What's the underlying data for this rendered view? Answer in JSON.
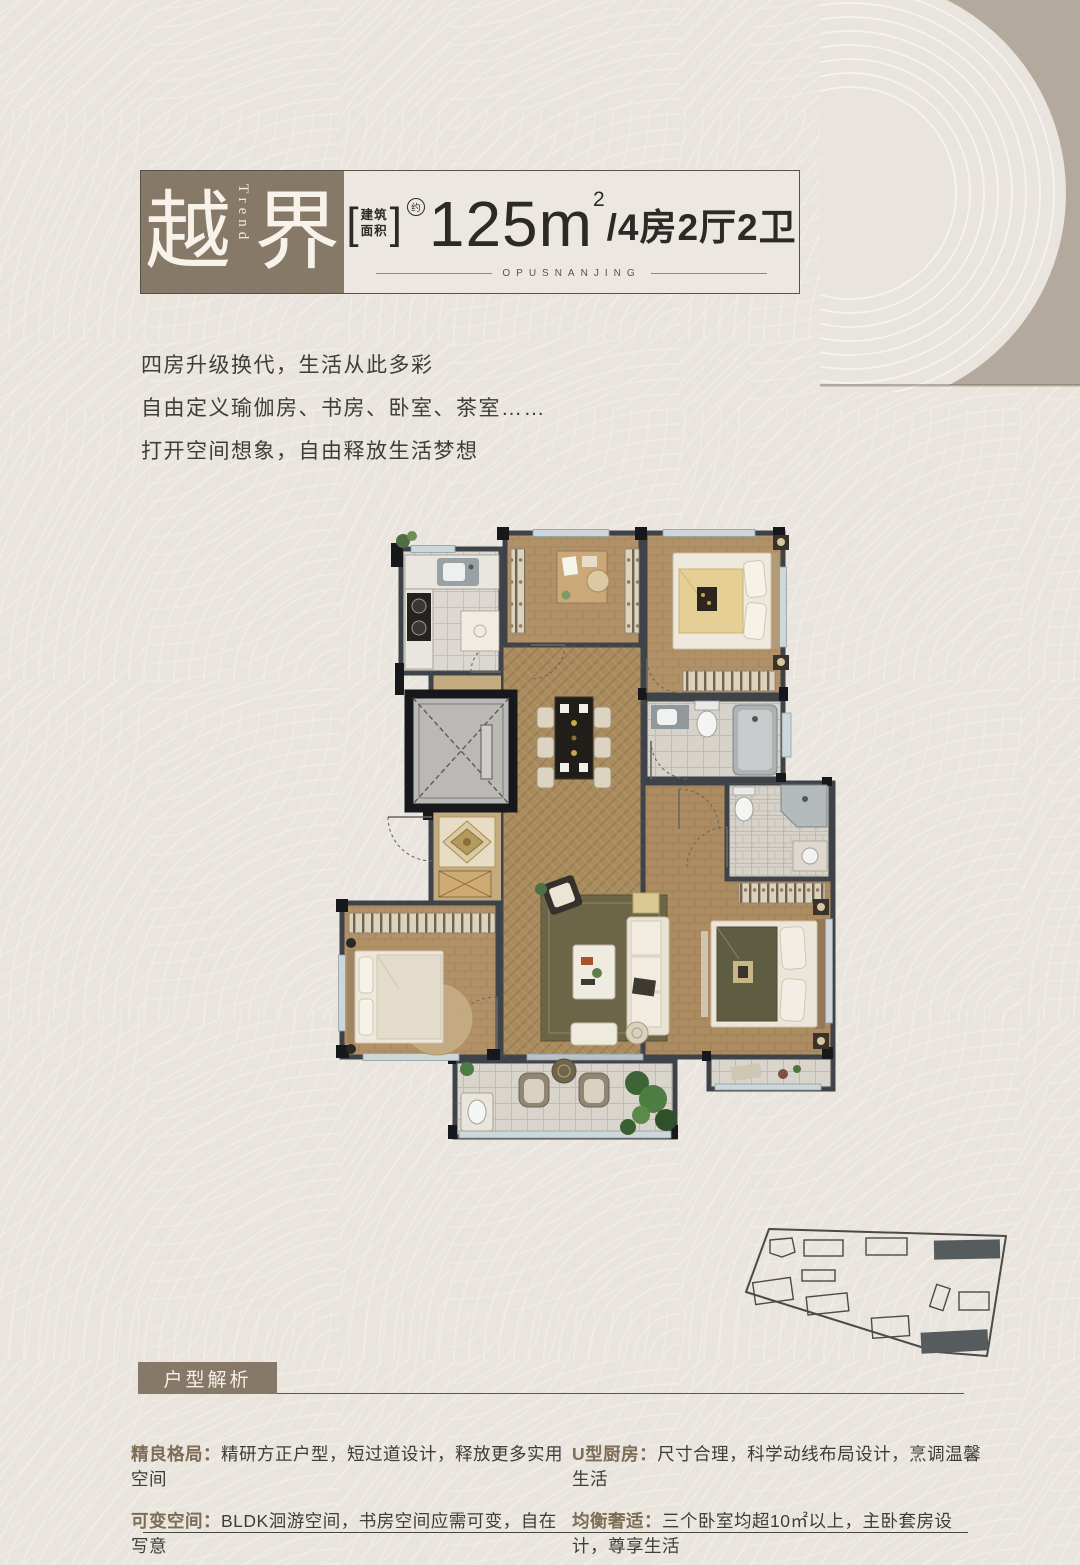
{
  "header": {
    "title_cn": "越界",
    "title_en": "Trend",
    "bracket_open": "[",
    "area_label_line1": "建筑",
    "area_label_line2": "面积",
    "bracket_close": "]",
    "approx_mark": "约",
    "area_number": "125",
    "area_unit": "m",
    "area_exponent": "2",
    "layout_text": "/4房2厅2卫",
    "brand_text": "OPUSNANJING"
  },
  "intro": {
    "line1": "四房升级换代，生活从此多彩",
    "line2": "自由定义瑜伽房、书房、卧室、茶室……",
    "line3": "打开空间想象，自由释放生活梦想"
  },
  "analysis": {
    "section_title": "户型解析",
    "features": [
      {
        "label": "精良格局：",
        "text": "精研方正户型，短过道设计，释放更多实用空间"
      },
      {
        "label": "U型厨房：",
        "text": "尺寸合理，科学动线布局设计，烹调温馨生活"
      },
      {
        "label": "可变空间：",
        "text": "BLDK洄游空间，书房空间应需可变，自在写意"
      },
      {
        "label": "均衡奢适：",
        "text": "三个卧室均超10㎡以上，主卧套房设计，尊享生活"
      }
    ]
  },
  "colors": {
    "page_bg": "#e9e4dd",
    "corner_band": "#b3a99c",
    "accent_brown": "#867968",
    "wall": "#3e4349",
    "text_dark": "#3f3c37",
    "label_brown": "#7c6d53",
    "wood_floor": "#b29168",
    "tile_floor": "#d7d3cb"
  }
}
